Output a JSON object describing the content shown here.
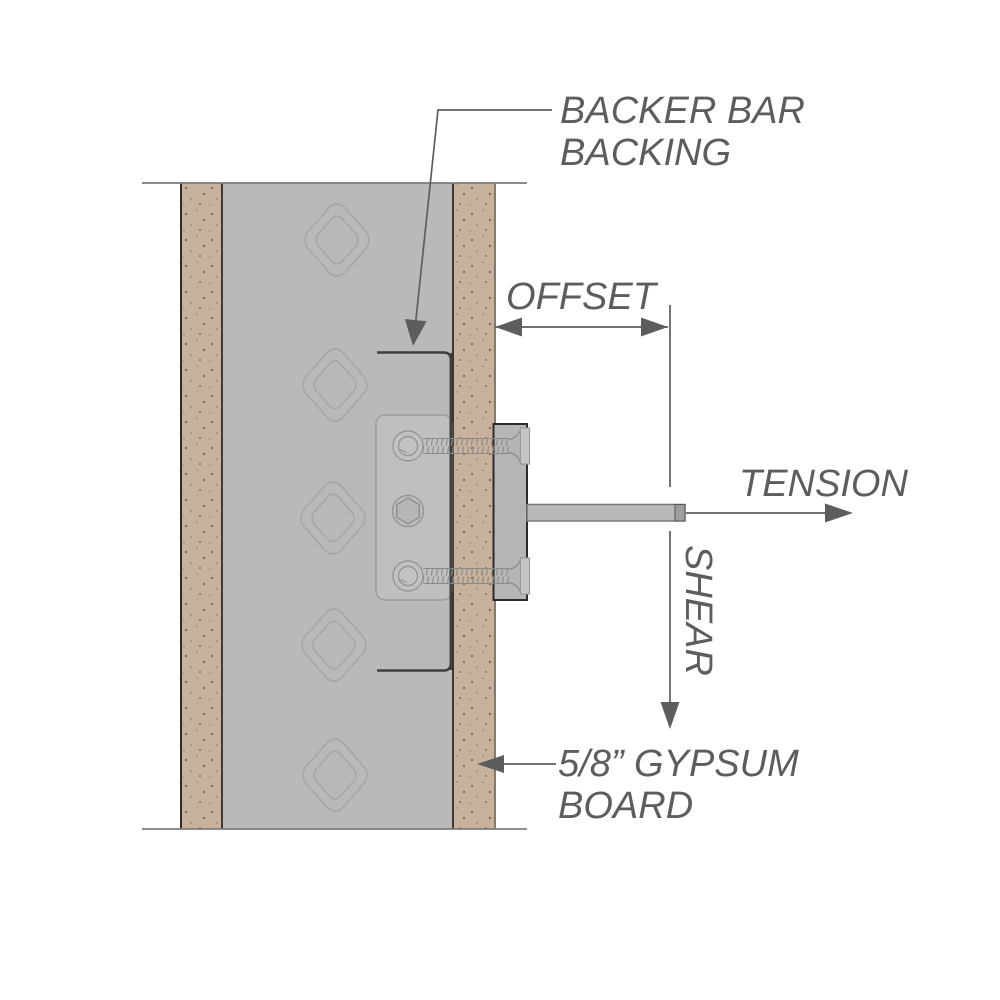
{
  "diagram": {
    "labels": {
      "backer_bar_line1": "BACKER BAR",
      "backer_bar_line2": "BACKING",
      "offset": "OFFSET",
      "tension": "TENSION",
      "shear": "SHEAR",
      "gypsum_line1": "5/8” GYPSUM",
      "gypsum_line2": "BOARD"
    },
    "colors": {
      "gypsum_board": "#c9b29c",
      "gypsum_speckle": "#5d5143",
      "metal_stud": "#b9b9b9",
      "backer_plate": "#bfbfbf",
      "fixture_plate": "#b5b5b5",
      "rod": "#b9b9b9",
      "outline_dark": "#2e2b28",
      "annotation": "#5d5d5d",
      "knockout_stroke": "#a6a6a6",
      "break_line": "#7d7d7d"
    }
  }
}
